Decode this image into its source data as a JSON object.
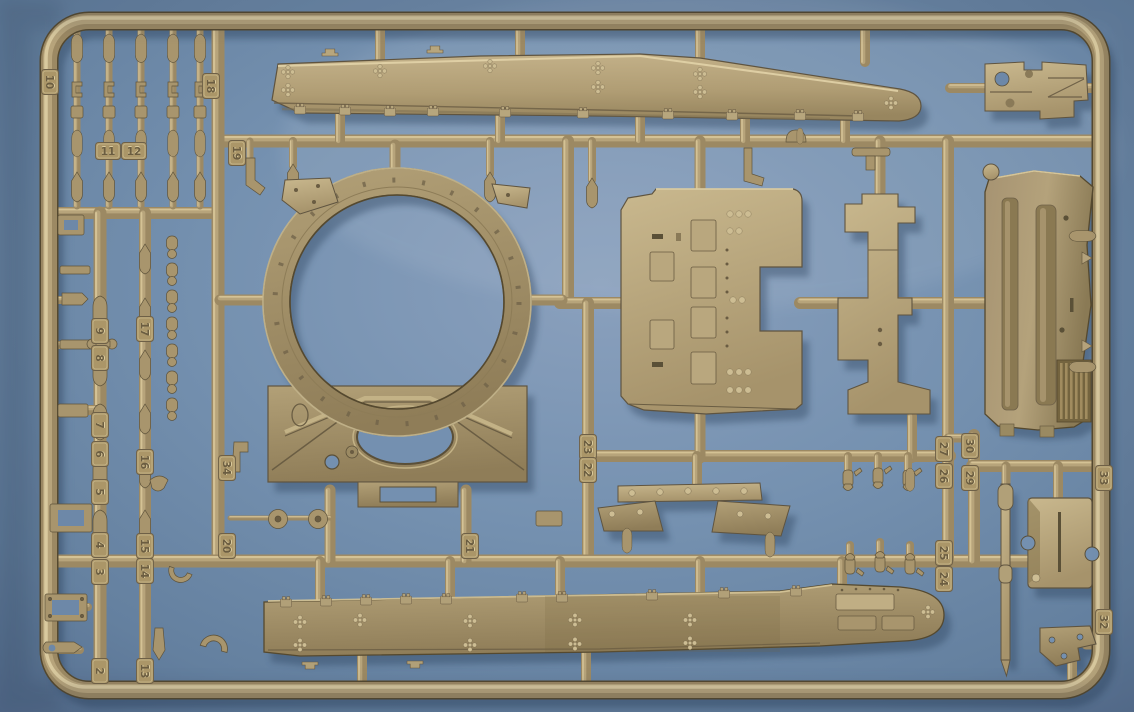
{
  "scene": {
    "type": "photograph",
    "subject": "Tan injection-molded plastic model kit sprue (parts tree) with numbered part tags, lying on a blue surface"
  },
  "colors": {
    "background_center": "#8399b8",
    "background_mid": "#7390b0",
    "background_edge": "#54708f",
    "plastic_light": "#d6c497",
    "plastic_mid": "#9c8963",
    "plastic_dark": "#5e533b",
    "plastic_deep": "#4a422d",
    "panel_olive": "#9a8a62",
    "shadow_blue": "#273c58"
  },
  "sprue": {
    "material": "tan styrene plastic",
    "background_surface": "blue table",
    "tags": [
      {
        "n": "10",
        "x": 50,
        "y": 82,
        "rot": 90
      },
      {
        "n": "18",
        "x": 211,
        "y": 86,
        "rot": 90
      },
      {
        "n": "11",
        "x": 108,
        "y": 151,
        "rot": 0
      },
      {
        "n": "12",
        "x": 134,
        "y": 151,
        "rot": 0
      },
      {
        "n": "19",
        "x": 237,
        "y": 153,
        "rot": 90
      },
      {
        "n": "9",
        "x": 100,
        "y": 331,
        "rot": 90
      },
      {
        "n": "8",
        "x": 100,
        "y": 358,
        "rot": 90
      },
      {
        "n": "7",
        "x": 100,
        "y": 425,
        "rot": 90
      },
      {
        "n": "6",
        "x": 100,
        "y": 454,
        "rot": 90
      },
      {
        "n": "5",
        "x": 100,
        "y": 492,
        "rot": 90
      },
      {
        "n": "4",
        "x": 100,
        "y": 545,
        "rot": 90
      },
      {
        "n": "3",
        "x": 100,
        "y": 572,
        "rot": 90
      },
      {
        "n": "2",
        "x": 100,
        "y": 671,
        "rot": 90
      },
      {
        "n": "17",
        "x": 145,
        "y": 329,
        "rot": 90
      },
      {
        "n": "16",
        "x": 145,
        "y": 462,
        "rot": 90
      },
      {
        "n": "15",
        "x": 145,
        "y": 546,
        "rot": 90
      },
      {
        "n": "14",
        "x": 145,
        "y": 571,
        "rot": 90
      },
      {
        "n": "13",
        "x": 145,
        "y": 671,
        "rot": 90
      },
      {
        "n": "34",
        "x": 227,
        "y": 468,
        "rot": 90
      },
      {
        "n": "20",
        "x": 227,
        "y": 546,
        "rot": 90
      },
      {
        "n": "21",
        "x": 470,
        "y": 546,
        "rot": 90
      },
      {
        "n": "23",
        "x": 588,
        "y": 447,
        "rot": 90
      },
      {
        "n": "22",
        "x": 588,
        "y": 470,
        "rot": 90
      },
      {
        "n": "27",
        "x": 944,
        "y": 449,
        "rot": 90
      },
      {
        "n": "26",
        "x": 944,
        "y": 476,
        "rot": 90
      },
      {
        "n": "30",
        "x": 970,
        "y": 446,
        "rot": 90
      },
      {
        "n": "29",
        "x": 970,
        "y": 478,
        "rot": 90
      },
      {
        "n": "25",
        "x": 944,
        "y": 553,
        "rot": 90
      },
      {
        "n": "24",
        "x": 944,
        "y": 579,
        "rot": 90
      },
      {
        "n": "33",
        "x": 1104,
        "y": 478,
        "rot": 90
      },
      {
        "n": "32",
        "x": 1104,
        "y": 622,
        "rot": 90
      }
    ],
    "rails": [
      [
        222,
        141,
        1096,
        141,
        13
      ],
      [
        55,
        213,
        216,
        213,
        12
      ],
      [
        218,
        28,
        218,
        561,
        13
      ],
      [
        100,
        213,
        100,
        686,
        13
      ],
      [
        145,
        213,
        145,
        686,
        12
      ],
      [
        568,
        141,
        568,
        303,
        12
      ],
      [
        560,
        303,
        626,
        303,
        12
      ],
      [
        800,
        303,
        986,
        303,
        12
      ],
      [
        588,
        303,
        588,
        561,
        12
      ],
      [
        588,
        456,
        950,
        456,
        12
      ],
      [
        55,
        561,
        1096,
        561,
        13
      ],
      [
        948,
        141,
        948,
        561,
        12
      ],
      [
        974,
        435,
        974,
        561,
        12
      ],
      [
        948,
        438,
        974,
        438,
        9
      ],
      [
        972,
        466,
        1096,
        466,
        12
      ],
      [
        330,
        490,
        330,
        561,
        11
      ],
      [
        466,
        490,
        466,
        561,
        11
      ],
      [
        55,
        410,
        98,
        410,
        10
      ],
      [
        77,
        28,
        77,
        206,
        7
      ],
      [
        109,
        28,
        109,
        206,
        7
      ],
      [
        141,
        28,
        141,
        206,
        7
      ],
      [
        173,
        28,
        173,
        206,
        7
      ],
      [
        200,
        28,
        200,
        206,
        7
      ],
      [
        380,
        28,
        380,
        60,
        10
      ],
      [
        520,
        26,
        520,
        54,
        10
      ],
      [
        700,
        28,
        700,
        58,
        10
      ],
      [
        865,
        28,
        865,
        62,
        10
      ],
      [
        340,
        112,
        340,
        141,
        10
      ],
      [
        500,
        114,
        500,
        141,
        10
      ],
      [
        640,
        116,
        640,
        141,
        10
      ],
      [
        745,
        118,
        745,
        141,
        10
      ],
      [
        845,
        116,
        845,
        141,
        10
      ],
      [
        395,
        145,
        395,
        180,
        11
      ],
      [
        220,
        300,
        266,
        300,
        11
      ],
      [
        530,
        300,
        562,
        300,
        11
      ],
      [
        700,
        141,
        700,
        194,
        11
      ],
      [
        700,
        414,
        700,
        458,
        11
      ],
      [
        880,
        141,
        880,
        196,
        11
      ],
      [
        912,
        416,
        912,
        458,
        10
      ],
      [
        950,
        88,
        986,
        88,
        10
      ],
      [
        1088,
        88,
        1098,
        88,
        10
      ],
      [
        320,
        561,
        320,
        602,
        10
      ],
      [
        450,
        561,
        450,
        600,
        10
      ],
      [
        560,
        561,
        560,
        598,
        10
      ],
      [
        700,
        561,
        700,
        595,
        10
      ],
      [
        842,
        561,
        842,
        586,
        10
      ],
      [
        362,
        654,
        362,
        688,
        10
      ],
      [
        586,
        652,
        586,
        688,
        10
      ],
      [
        697,
        456,
        697,
        486,
        10
      ],
      [
        1058,
        466,
        1058,
        500,
        10
      ],
      [
        1006,
        466,
        1006,
        484,
        9
      ],
      [
        1072,
        662,
        1072,
        686,
        10
      ],
      [
        1086,
        645,
        1098,
        645,
        9
      ],
      [
        56,
        225,
        80,
        225,
        8
      ],
      [
        56,
        300,
        78,
        300,
        8
      ],
      [
        56,
        345,
        92,
        345,
        8
      ],
      [
        56,
        520,
        88,
        520,
        8
      ],
      [
        56,
        607,
        88,
        607,
        8
      ],
      [
        56,
        650,
        80,
        650,
        8
      ],
      [
        230,
        518,
        330,
        518,
        5
      ],
      [
        293,
        141,
        293,
        166,
        8
      ],
      [
        490,
        141,
        490,
        174,
        8
      ],
      [
        592,
        141,
        592,
        180,
        8
      ],
      [
        250,
        141,
        250,
        158,
        7
      ],
      [
        848,
        456,
        848,
        470,
        8
      ],
      [
        878,
        456,
        878,
        470,
        8
      ],
      [
        908,
        456,
        908,
        470,
        8
      ],
      [
        850,
        545,
        850,
        561,
        8
      ],
      [
        880,
        542,
        880,
        561,
        8
      ],
      [
        910,
        545,
        910,
        561,
        8
      ]
    ],
    "parts": [
      {
        "name": "side-skirt-top",
        "desc": "long tapered side skirt with diamond bolt clusters and lifting handles"
      },
      {
        "name": "turret-ring-plate",
        "desc": "hull roof plate with large circular turret ring opening and oval hatch hole"
      },
      {
        "name": "hull-plate",
        "desc": "flat plate with six raised hatch panels, rivets and right-side notch"
      },
      {
        "name": "stepped-bracket",
        "desc": "narrow stepped mounting bracket"
      },
      {
        "name": "engine-panel",
        "desc": "tall panel with vertical ribs and grille"
      },
      {
        "name": "top-right-plate",
        "desc": "small flat plate with round holes"
      },
      {
        "name": "side-skirt-bottom",
        "desc": "long side skirt, rounded right end, hinges along top edge"
      },
      {
        "name": "mudflap-brackets",
        "desc": "pair of mirrored angled bracket plates"
      },
      {
        "name": "storage-box",
        "desc": "small rectangular box with slot and side cutouts"
      },
      {
        "name": "suspension-small-parts",
        "desc": "columns of small dampers, cones, clamps and links"
      }
    ]
  }
}
